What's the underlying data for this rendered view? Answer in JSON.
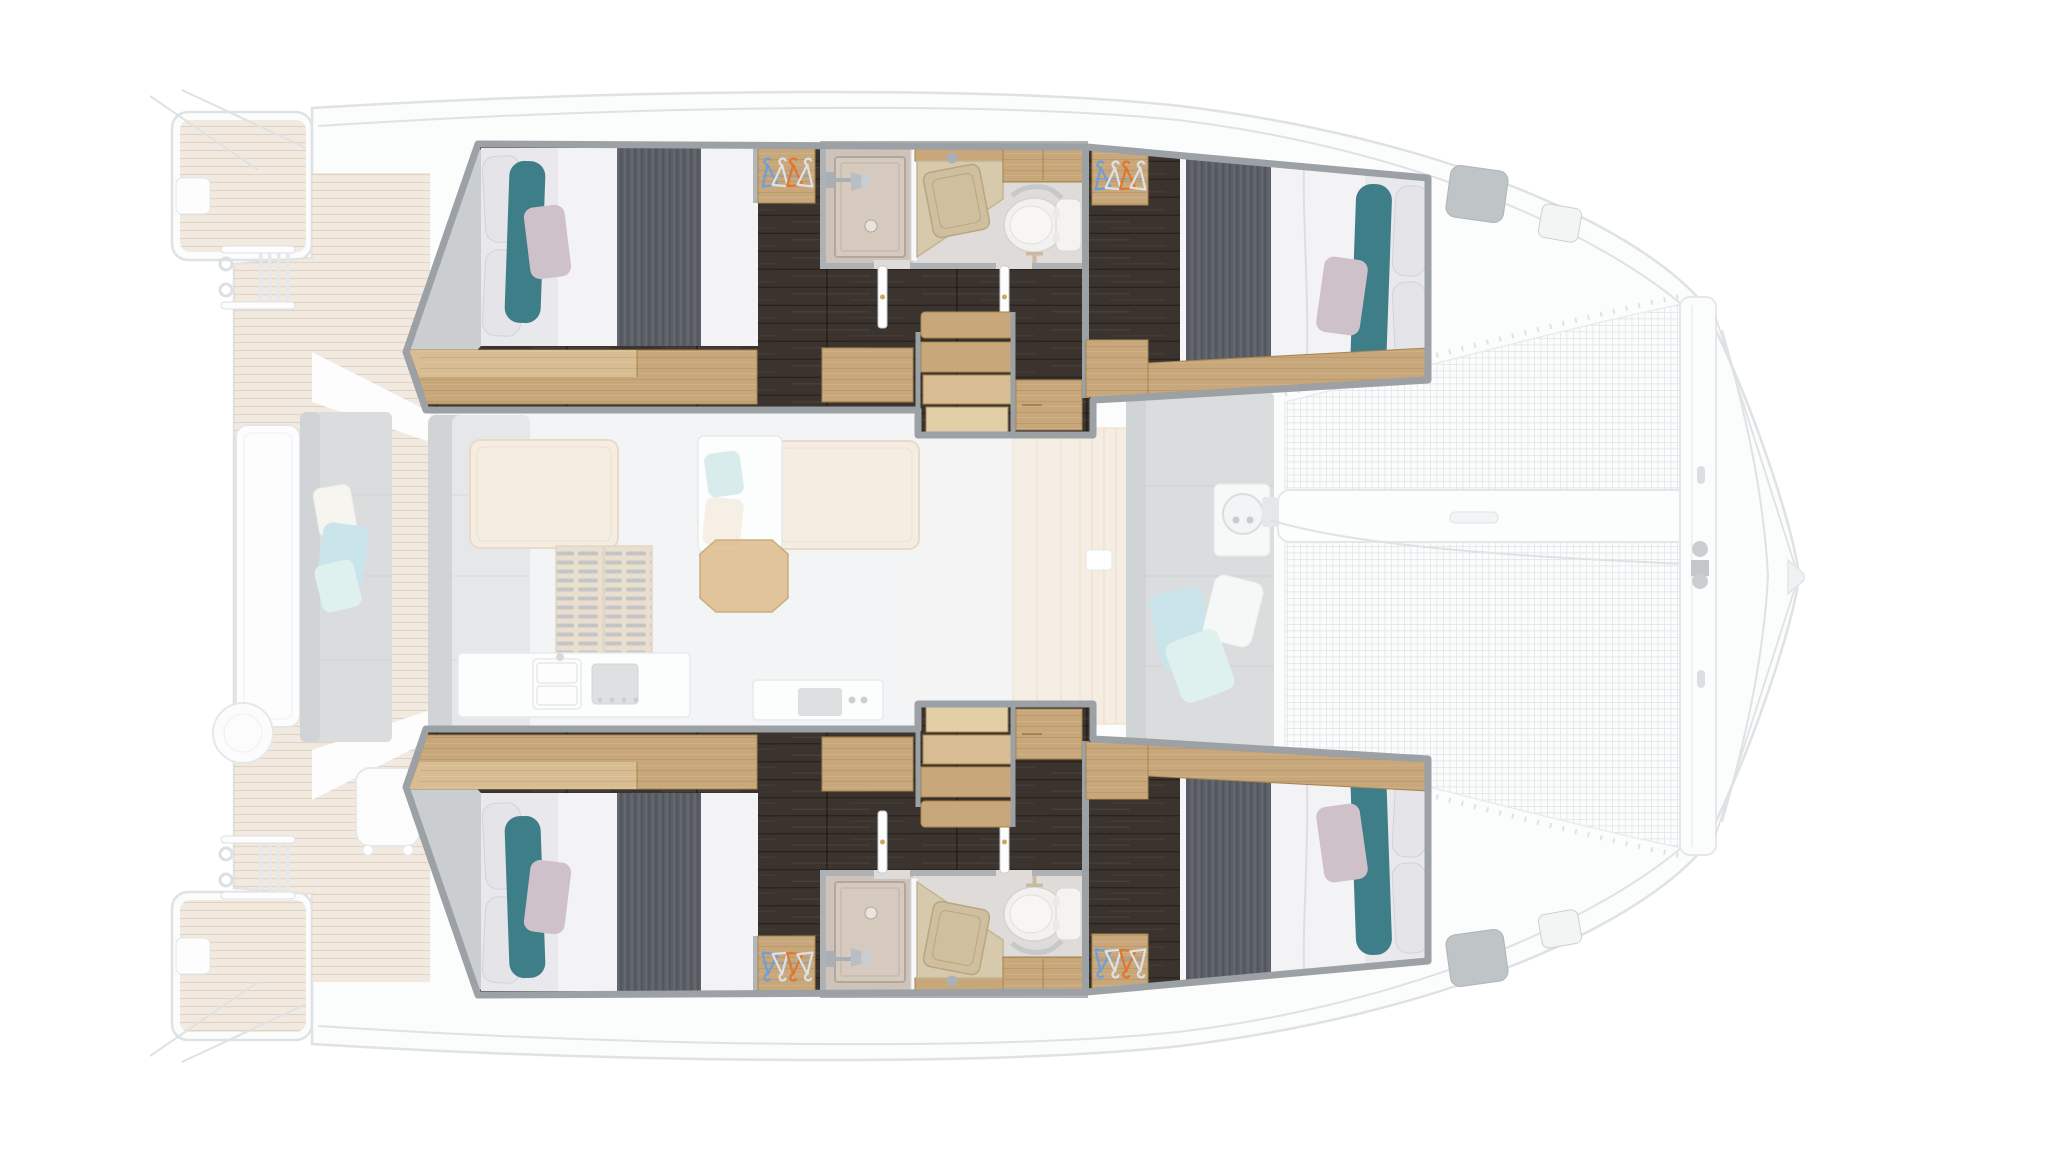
{
  "meta": {
    "title": "Catamaran 4-cabin interior layout plan — top-down view, bow right, twin sterns left"
  },
  "colors": {
    "background": "#ffffff",
    "wallGray": "#9ba1a5",
    "bathWall": "#aeb2b5",
    "darkFloor": "#3b332d",
    "woodMain": "#c8a77b",
    "woodLight": "#d9bd92",
    "woodDark": "#a3854f",
    "woodStep": "#e3cfa7",
    "sheet": "#e9e9ed",
    "duvet": "#f3f3f6",
    "blanket": "#5b5f67",
    "tealPillow": "#3e7e88",
    "lilacPillow": "#cfc1c9",
    "whitePillow": "#e4e4e9",
    "bathFloor": "#dfdbd8",
    "showerBase": "#cdc3ba",
    "showerTray": "#d6cabf",
    "counterBeige": "#d6c9ac",
    "sinkBeige": "#cfbf9e",
    "toiletWhite": "#f2f1ef",
    "chrome": "#aab0b5",
    "handleGold": "#c9a85c",
    "hangerBlue": "#6f9fd8",
    "hangerOrange": "#e0772f",
    "hangerWhite": "#dde0e5",
    "ghostLine": "#dcdfe2",
    "ghostWhite": "#fbfcfc",
    "ghostGray": "#d8d9db",
    "ghostGrayDark": "#cdd0d3",
    "ghostAqua": "#c5e2ea",
    "ghostAqua2": "#dcf0ee",
    "ghostBeige": "#f5ede3",
    "ghostTable": "#f5ebdf",
    "centerTableWood": "#dcb888"
  },
  "layout": {
    "orientation": {
      "bow": "right",
      "stern": "left",
      "view": "top-down deck plan"
    },
    "hulls": [
      {
        "name": "hull-top",
        "spaces": [
          "aft double cabin with teal bolster and lilac pillow",
          "wardrobe with blue, white and orange hangers",
          "en-suite bathroom: shower stall, washbasin counter, marine toilet",
          "dark plank corridor with two doors",
          "companionway stairs (wood steps)",
          "forward double cabin with wardrobe, nightstand and foot shelf"
        ]
      },
      {
        "name": "hull-bottom",
        "mirror_of": "hull-top"
      }
    ],
    "deck_ghosted": {
      "aft": [
        "two teak swim platforms",
        "two boarding ladders",
        "teak aft deck",
        "cockpit table",
        "cockpit bench with three cushions",
        "round stool",
        "side chair"
      ],
      "saloon": [
        "L-sofa",
        "two dining tables",
        "daybed with aqua and cream cushions",
        "teak floor grate",
        "galley sink unit",
        "galley stove unit",
        "center wood table"
      ],
      "foredeck": [
        "beige locker panels",
        "anchor locker lid",
        "forward bench with blue, white and aqua cushions",
        "anchor windlass",
        "two deck hatches per side",
        "trampoline net",
        "longitudinal beam",
        "forward crossbeam with fittings",
        "bowsprit bridle lines"
      ]
    }
  }
}
